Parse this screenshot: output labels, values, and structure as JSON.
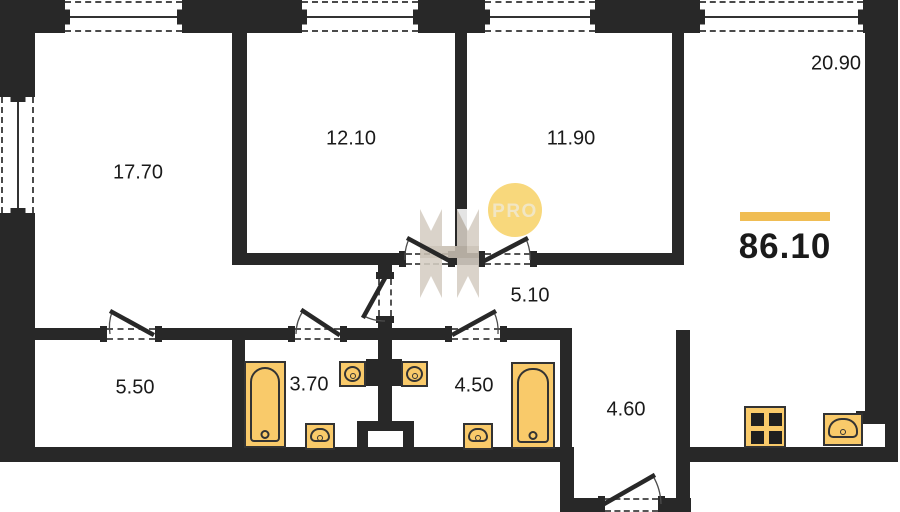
{
  "plan": {
    "total_area": "86.10",
    "rooms": [
      {
        "id": "room-17-70",
        "area": "17.70"
      },
      {
        "id": "room-12-10",
        "area": "12.10"
      },
      {
        "id": "room-11-90",
        "area": "11.90"
      },
      {
        "id": "kitchen-living-20-90",
        "area": "20.90"
      },
      {
        "id": "corridor-5-10",
        "area": "5.10"
      },
      {
        "id": "room-5-50",
        "area": "5.50"
      },
      {
        "id": "bathroom-3-70",
        "area": "3.70"
      },
      {
        "id": "bathroom-4-50",
        "area": "4.50"
      },
      {
        "id": "hallway-4-60",
        "area": "4.60"
      }
    ],
    "fixtures": [
      "bathtub",
      "washbasin",
      "toilet",
      "sink",
      "stove",
      "ventilation-shaft"
    ]
  },
  "watermark": {
    "text": "PRO"
  },
  "colors": {
    "wall": "#282828",
    "background": "#ffffff",
    "fixture-fill": "#F9CA6A",
    "fixture-line": "#333333",
    "accent": "#F0BD53",
    "label": "#1a1a1a",
    "wm-circle": "#F8D87C",
    "wm-text": "#F1E6C4",
    "wm-logo": "#D5CEC3",
    "wm-logo-dark": "#C8BFB2"
  }
}
